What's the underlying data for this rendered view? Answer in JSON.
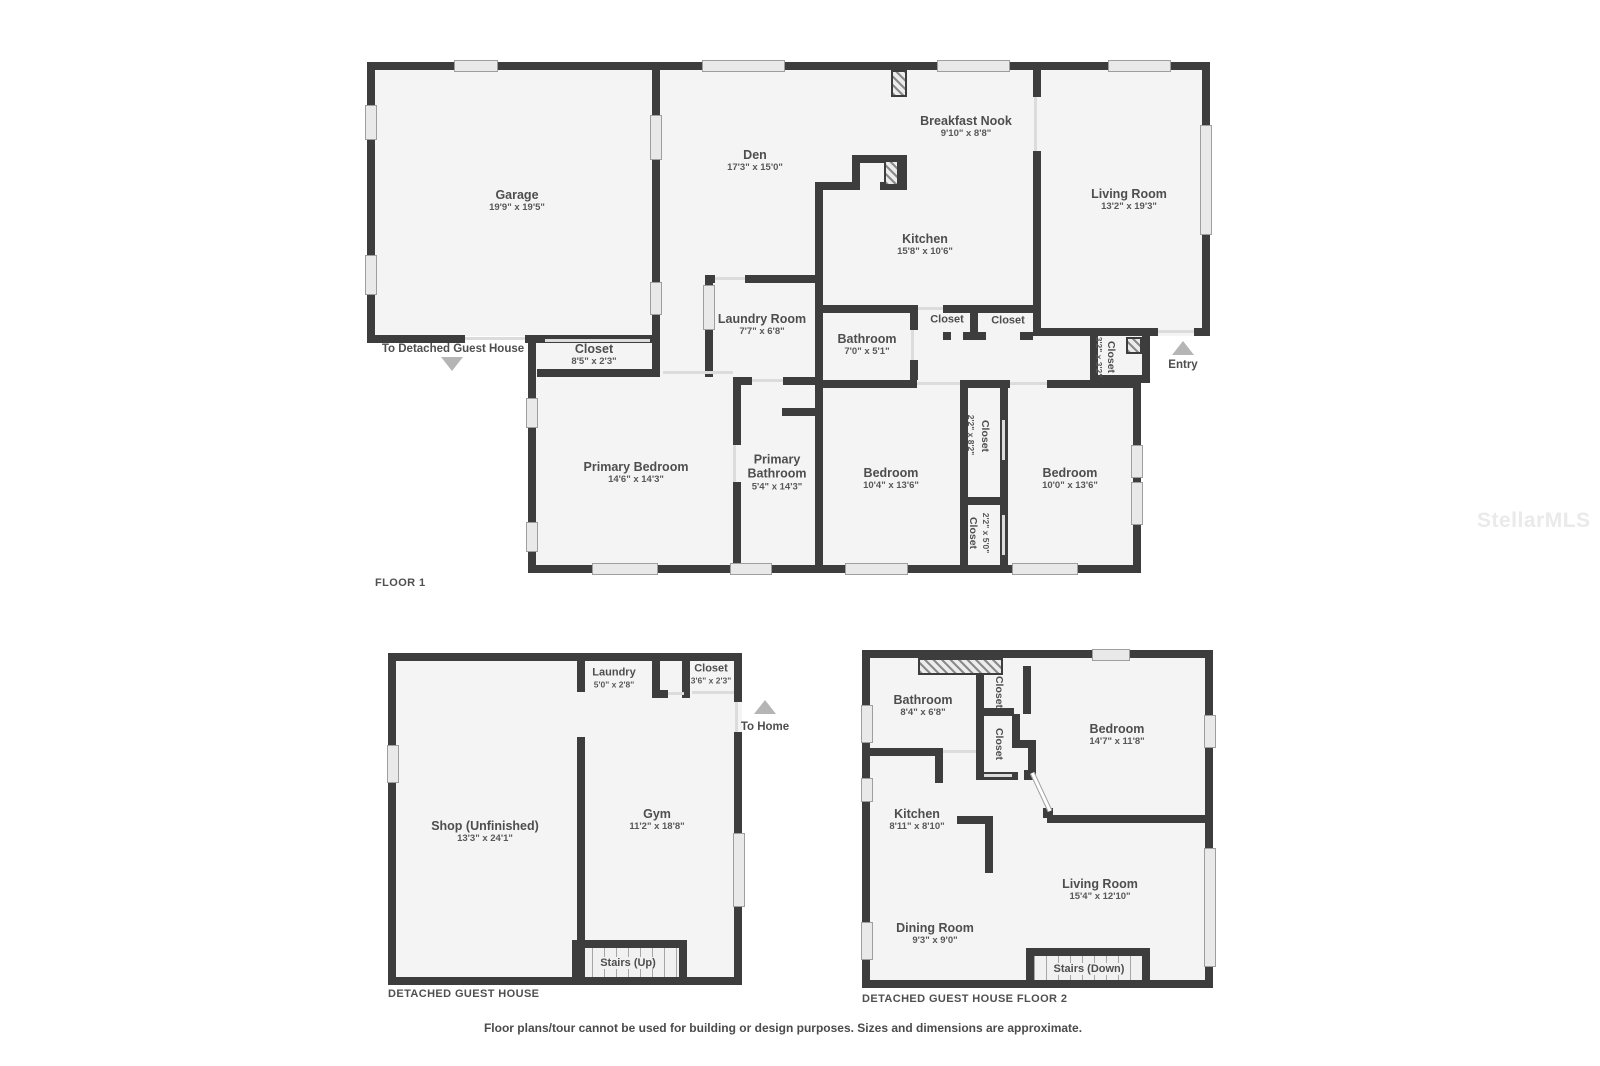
{
  "colors": {
    "wall": "#3d3d3d",
    "room_fill": "#f4f4f4",
    "window_fill": "#e9e9e9",
    "window_border": "#9e9e9e",
    "door_line": "#dcdcdc",
    "label_text": "#4e4e4e",
    "dims_text": "#585858",
    "arrow": "#b5b5b5",
    "caption_text": "#4f4f4f",
    "watermark": "#eaeaea"
  },
  "watermark": "StellarMLS",
  "footer": "Floor plans/tour cannot be used for building or design purposes. Sizes and dimensions are approximate.",
  "floor1": {
    "caption": "FLOOR 1",
    "annotations": {
      "to_guest_house": "To Detached Guest House",
      "entry": "Entry"
    },
    "rooms": [
      {
        "name": "Garage",
        "dims": "19'9\" x 19'5\""
      },
      {
        "name": "Den",
        "dims": "17'3\" x 15'0\""
      },
      {
        "name": "Breakfast Nook",
        "dims": "9'10\" x 8'8\""
      },
      {
        "name": "Kitchen",
        "dims": "15'8\" x 10'6\""
      },
      {
        "name": "Living Room",
        "dims": "13'2\" x 19'3\""
      },
      {
        "name": "Laundry Room",
        "dims": "7'7\" x 6'8\""
      },
      {
        "name": "Bathroom",
        "dims": "7'0\" x 5'1\""
      },
      {
        "name": "Closet"
      },
      {
        "name": "Closet"
      },
      {
        "name": "Closet",
        "dims": "3'2\" x 3'2\""
      },
      {
        "name": "Closet",
        "dims": "8'5\" x 2'3\""
      },
      {
        "name": "Primary Bedroom",
        "dims": "14'6\" x 14'3\""
      },
      {
        "name": "Primary Bathroom",
        "dims": "5'4\" x 14'3\""
      },
      {
        "name": "Bedroom",
        "dims": "10'4\" x 13'6\""
      },
      {
        "name": "Bedroom",
        "dims": "10'0\" x 13'6\""
      },
      {
        "name": "Closet",
        "dims": "2'2\" x 8'2\""
      },
      {
        "name": "Closet",
        "dims": "2'2\" x 5'0\""
      }
    ]
  },
  "guest1": {
    "caption": "DETACHED GUEST HOUSE",
    "annotations": {
      "to_home": "To Home",
      "stairs": "Stairs (Up)"
    },
    "rooms": [
      {
        "name": "Shop (Unfinished)",
        "dims": "13'3\" x 24'1\""
      },
      {
        "name": "Gym",
        "dims": "11'2\" x 18'8\""
      },
      {
        "name": "Laundry",
        "dims": "5'0\" x 2'8\""
      },
      {
        "name": "Closet",
        "dims": "3'6\" x 2'3\""
      }
    ]
  },
  "guest2": {
    "caption": "DETACHED GUEST HOUSE FLOOR 2",
    "annotations": {
      "stairs": "Stairs (Down)"
    },
    "rooms": [
      {
        "name": "Bathroom",
        "dims": "8'4\" x 6'8\""
      },
      {
        "name": "Closet"
      },
      {
        "name": "Closet"
      },
      {
        "name": "Bedroom",
        "dims": "14'7\" x 11'8\""
      },
      {
        "name": "Kitchen",
        "dims": "8'11\" x 8'10\""
      },
      {
        "name": "Living Room",
        "dims": "15'4\" x 12'10\""
      },
      {
        "name": "Dining Room",
        "dims": "9'3\" x 9'0\""
      }
    ]
  }
}
